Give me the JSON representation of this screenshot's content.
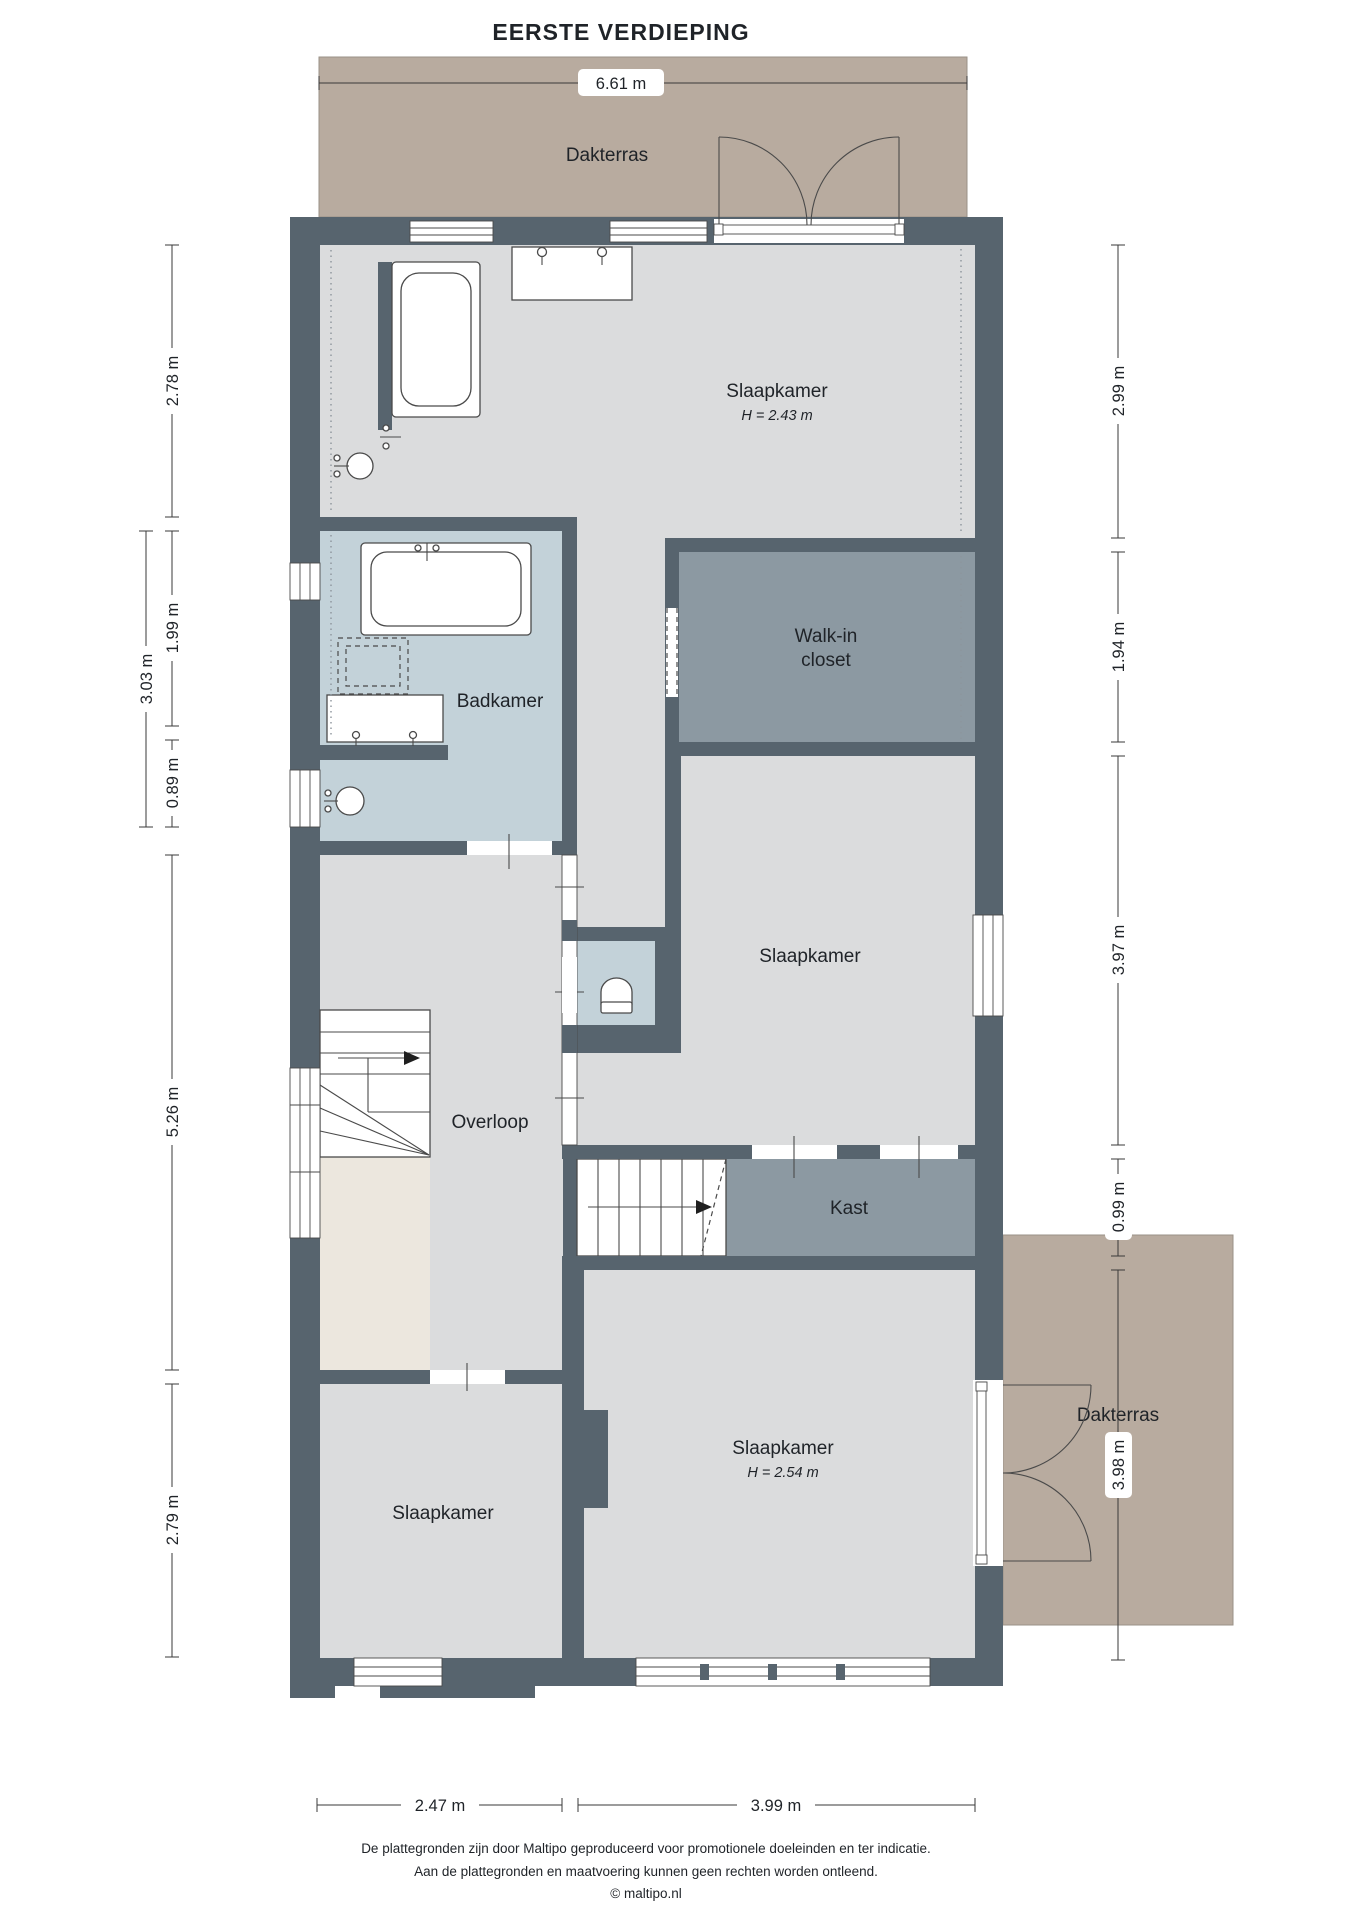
{
  "title": "EERSTE VERDIEPING",
  "terraces": {
    "top": "Dakterras",
    "right": "Dakterras"
  },
  "rooms": {
    "slaapkamer_top": "Slaapkamer",
    "slaapkamer_top_height": "H = 2.43 m",
    "badkamer": "Badkamer",
    "walk_in_line1": "Walk-in",
    "walk_in_line2": "closet",
    "slaapkamer_mid": "Slaapkamer",
    "overloop": "Overloop",
    "kast": "Kast",
    "slaapkamer_bottom_left": "Slaapkamer",
    "slaapkamer_bottom_right": "Slaapkamer",
    "slaapkamer_bottom_right_height": "H = 2.54 m"
  },
  "dimensions": {
    "top": "6.61 m",
    "left": {
      "d278": "2.78 m",
      "d303": "3.03 m",
      "d199": "1.99 m",
      "d089": "0.89 m",
      "d526": "5.26 m",
      "d279": "2.79 m"
    },
    "right": {
      "d299": "2.99 m",
      "d194": "1.94 m",
      "d397": "3.97 m",
      "d099": "0.99 m",
      "d398": "3.98 m"
    },
    "bottom": {
      "d247": "2.47 m",
      "d399": "3.99 m"
    }
  },
  "footer": {
    "line1": "De plattegronden zijn door Maltipo geproduceerd voor promotionele doeleinden en ter indicatie.",
    "line2": "Aan de plattegronden en maatvoering kunnen geen rechten worden ontleend.",
    "line3": "© maltipo.nl"
  },
  "palette": {
    "wall": "#57646E",
    "floor": "#DBDCDD",
    "wet": "#C3D2D9",
    "closet": "#8C99A2",
    "terrace": "#B8AB9F",
    "void": "#ECE7DE",
    "line": "#3A3A3A",
    "text": "#1F2328"
  }
}
